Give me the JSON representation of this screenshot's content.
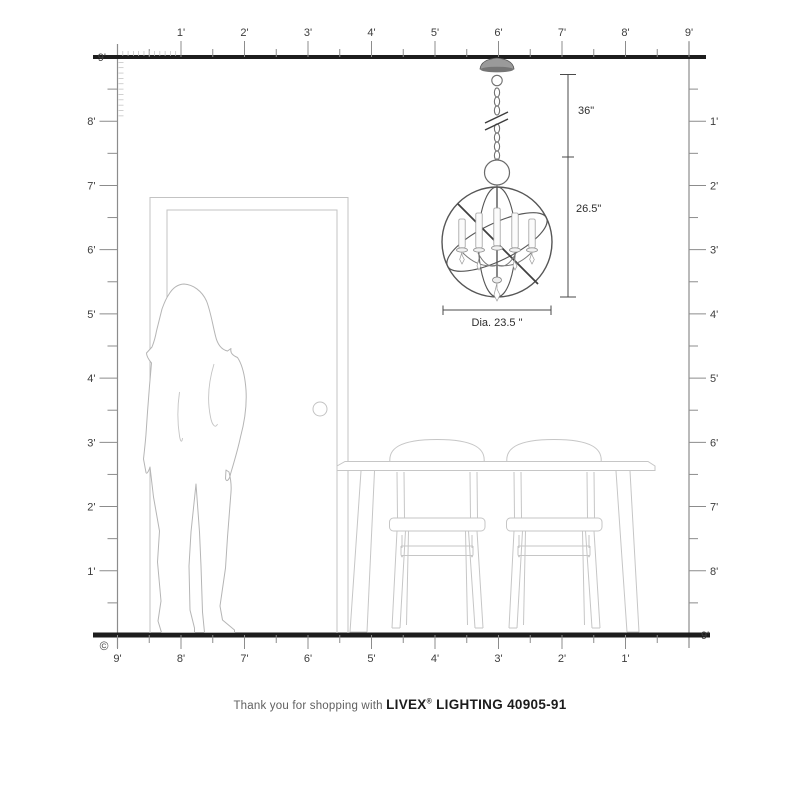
{
  "rulers": {
    "top": {
      "labels": [
        "1'",
        "2'",
        "3'",
        "4'",
        "5'",
        "6'",
        "7'",
        "8'",
        "9'"
      ]
    },
    "left": {
      "top_label": "9'",
      "labels": [
        "8'",
        "7'",
        "6'",
        "5'",
        "4'",
        "3'",
        "2'",
        "1'"
      ]
    },
    "right": {
      "labels": [
        "1'",
        "2'",
        "3'",
        "4'",
        "5'",
        "6'",
        "7'",
        "8'"
      ],
      "bottom_label": "9'"
    },
    "bottom": {
      "labels": [
        "9'",
        "8'",
        "7'",
        "6'",
        "5'",
        "4'",
        "3'",
        "2'",
        "1'"
      ]
    }
  },
  "dimensions": {
    "chain_length": "36\"",
    "fixture_height": "26.5\"",
    "diameter": "Dia. 23.5 \""
  },
  "footer": {
    "prefix": "Thank you for shopping with",
    "brand": "LIVEX",
    "registered": "®",
    "suffix": "LIGHTING 40905-91"
  },
  "copyright": "©",
  "colors": {
    "ruler_thick": "#1d1d1d",
    "ruler_thin": "#8c8c8c",
    "tick": "#8c8c8c",
    "inch_tick": "#bdbdbd",
    "label": "#3d3d3d",
    "artwork_light": "#c4c4c4",
    "person_outline": "#b5b5b5",
    "chandelier": "#565656",
    "dimension_line": "#4a4a4a"
  }
}
